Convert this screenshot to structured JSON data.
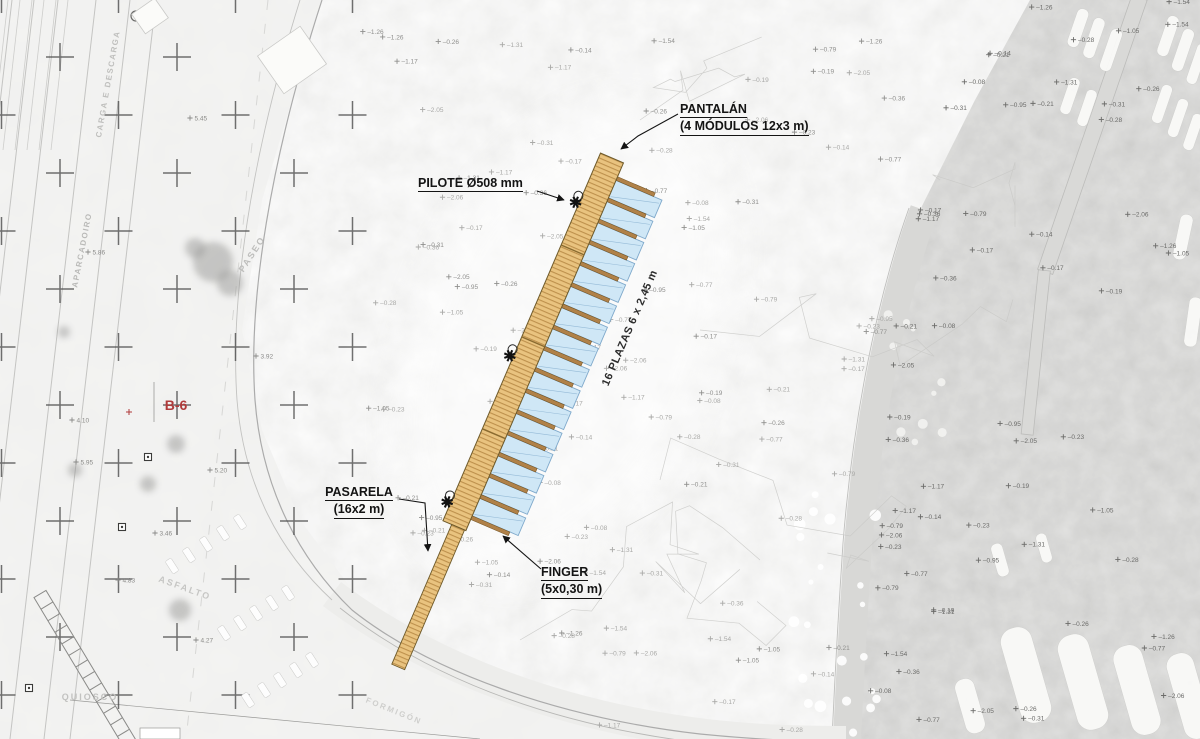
{
  "drawing": {
    "annotations": {
      "pantalan_line1": "PANTALÁN",
      "pantalan_line2": "(4 MÓDULOS 12x3 m)",
      "pilote": "PILOTE Ø508 mm",
      "pasarela_line1": "PASARELA",
      "pasarela_line2": "(16x2 m)",
      "finger_line1": "FINGER",
      "finger_line2": "(5x0,30 m)",
      "plazas": "16 PLAZAS 6 x 2,45 m",
      "berth_ref": "B-6"
    },
    "structure": {
      "module_count": 4,
      "berth_count": 16,
      "finger_count": 17,
      "pile_count": 3
    },
    "map_labels": [
      {
        "id": "carga",
        "text": "CARGA E DESCARGA",
        "x": 108,
        "y": 84,
        "rot": -80,
        "size": 8,
        "ls": 1.5,
        "color": "#bfbfbd"
      },
      {
        "id": "aparcadoiro",
        "text": "APARCADOIRO",
        "x": 82,
        "y": 250,
        "rot": -79,
        "size": 8,
        "ls": 1.5,
        "color": "#b9b9b7"
      },
      {
        "id": "paseo",
        "text": "PASEO",
        "x": 252,
        "y": 254,
        "rot": -57,
        "size": 9,
        "ls": 2,
        "color": "#bdbdbb"
      },
      {
        "id": "asfalto",
        "text": "ASFALTO",
        "x": 185,
        "y": 588,
        "rot": 20,
        "size": 9,
        "ls": 2,
        "color": "#c6c6c4"
      },
      {
        "id": "quiosco",
        "text": "QUIOSCO",
        "x": 90,
        "y": 697,
        "rot": 0,
        "size": 9,
        "ls": 2,
        "color": "#c2c2c0"
      },
      {
        "id": "formigon",
        "text": "FORMIGÓN",
        "x": 394,
        "y": 711,
        "rot": 22,
        "size": 8,
        "ls": 2,
        "color": "#cfcfcd"
      }
    ],
    "colors": {
      "deck": "#e9c37f",
      "deck_hatch": "#bd904c",
      "deck_edge": "#6e5a2a",
      "berth_fill": "#cfe7f6",
      "berth_edge": "#7fa9cb",
      "berth_line": "#8fb6d4",
      "finger_fill": "#b08148",
      "finger_edge": "#6e4f1e",
      "annotation": "#141414",
      "berth_ref_red": "#b03a3a",
      "land": "#e4e4e2",
      "beach": "#f4f4f2",
      "water": "#b7b7b5"
    },
    "survey": {
      "sea_values": [
        "-0.14",
        "-0.21",
        "-0.26",
        "-0.31",
        "-0.28",
        "-1.05",
        "-1.17",
        "-0.77",
        "-2.05",
        "-0.08",
        "-1.26",
        "-0.17",
        "-1.54",
        "-2.06",
        "-0.19",
        "-0.36",
        "-0.79",
        "-1.31",
        "-0.95",
        "-0.23"
      ],
      "land_values": [
        "5.86",
        "4.10",
        "5.95",
        "3.46",
        "4.27",
        "6.17",
        "5.45",
        "3.92",
        "4.83",
        "5.20"
      ]
    }
  }
}
